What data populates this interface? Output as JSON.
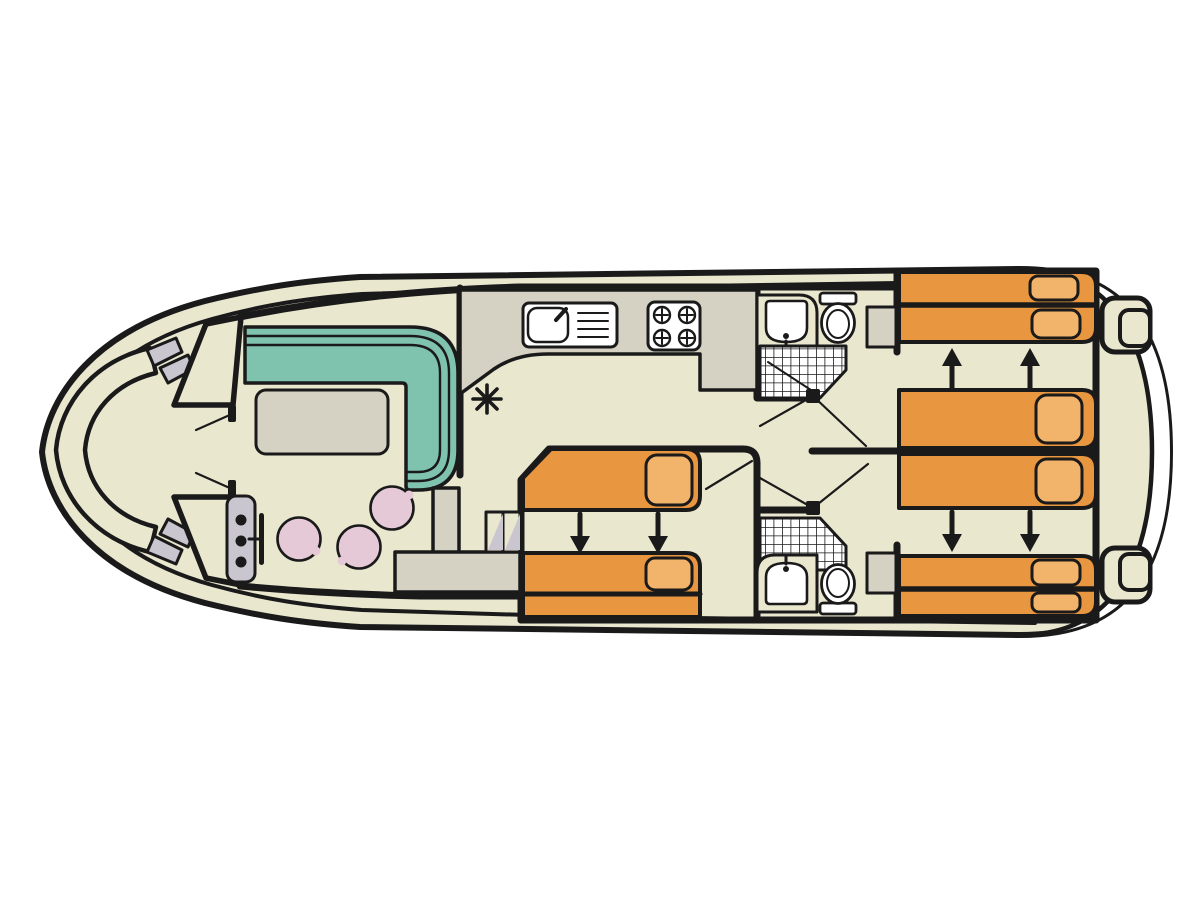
{
  "diagram": {
    "type": "boat-floorplan-top-view",
    "orientation": "bow-left-stern-right",
    "palette": {
      "background": "#ffffff",
      "outline": "#1a1a1a",
      "deck_cream": "#EAE7CF",
      "hull_white": "#ffffff",
      "furniture_gray": "#D5D1C3",
      "steps_gray": "#C9C6D0",
      "sofa_teal": "#7FC3AE",
      "bed_orange": "#E8963F",
      "pillow_orange": "#F2B36A",
      "chair_pink": "#E6C9D7",
      "fixture_white": "#ffffff"
    },
    "areas": {
      "bow_cockpit": {
        "features": [
          "curved-bench",
          "boarding-steps-port",
          "boarding-steps-starboard",
          "entry-doors"
        ]
      },
      "saloon": {
        "features": [
          "l-shaped-sofa",
          "table",
          "swivel-chair",
          "swivel-chair",
          "swivel-chair",
          "helm-console",
          "steering-wheel"
        ],
        "chair_count": 3,
        "helm_instrument_dots": 3
      },
      "galley": {
        "features": [
          "counter",
          "sink-with-drainer",
          "hob",
          "lower-counter",
          "companionway-steps",
          "heater-symbol"
        ],
        "hob_burners": 4,
        "step_treads": 2
      },
      "mid_cabin": {
        "beds": 2,
        "arrow_direction": "down",
        "arrow_count": 2,
        "pillows": 2
      },
      "bathroom_fwd": {
        "features": [
          "washbasin",
          "toilet",
          "shower-grid",
          "door-swing"
        ]
      },
      "bathroom_aft": {
        "features": [
          "washbasin",
          "toilet",
          "shower-grid",
          "door-swing"
        ]
      },
      "cabin_aft_top": {
        "beds": 2,
        "arrow_direction": "up",
        "arrow_count": 2,
        "pillows": 3
      },
      "cabin_aft_bottom": {
        "beds": 2,
        "arrow_direction": "down",
        "arrow_count": 2,
        "pillows": 3
      },
      "wardrobes": 2,
      "stern_deck": {
        "features": [
          "steps-top",
          "steps-bottom",
          "swim-deck"
        ]
      }
    },
    "symbols": {
      "heater_asterisk_spokes": 8,
      "arrow_color": "#1a1a1a",
      "shower_grid_cell_px": 8.5
    }
  }
}
